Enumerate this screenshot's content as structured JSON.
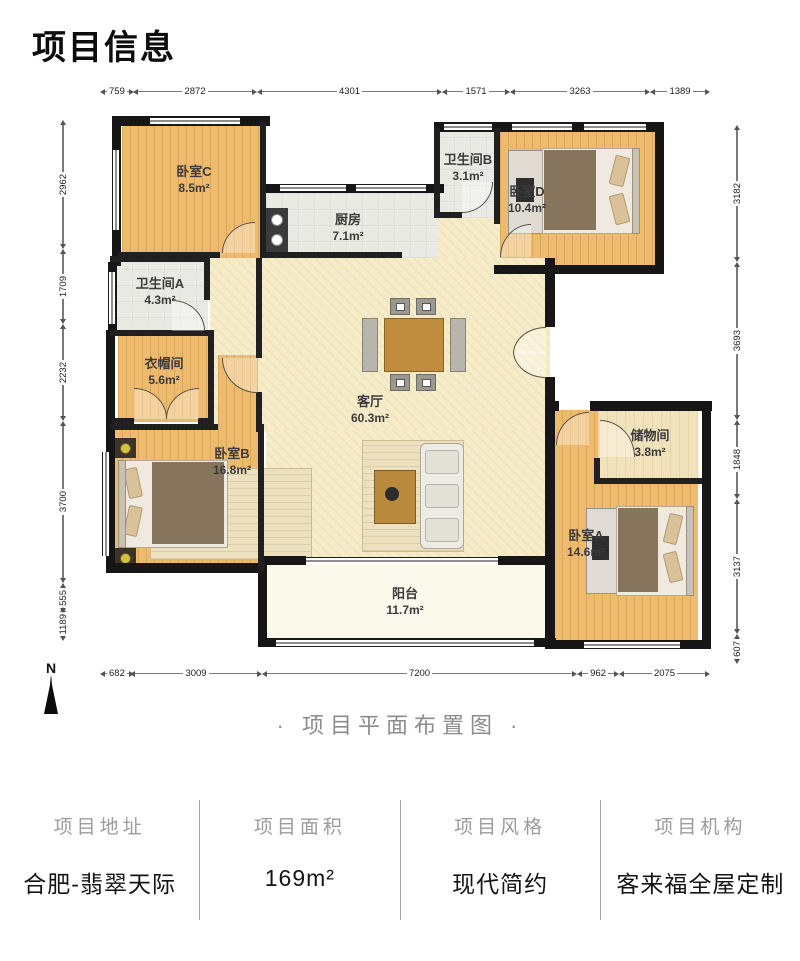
{
  "title": "项目信息",
  "caption": "· 项目平面布置图 ·",
  "compass": {
    "label": "N"
  },
  "plan": {
    "rooms": [
      {
        "name": "卧室C",
        "area": "8.5m²"
      },
      {
        "name": "厨房",
        "area": "7.1m²"
      },
      {
        "name": "卫生间B",
        "area": "3.1m²"
      },
      {
        "name": "卧室D",
        "area": "10.4m²"
      },
      {
        "name": "卫生间A",
        "area": "4.3m²"
      },
      {
        "name": "衣帽间",
        "area": "5.6m²"
      },
      {
        "name": "客厅",
        "area": "60.3m²"
      },
      {
        "name": "卧室B",
        "area": "16.8m²"
      },
      {
        "name": "储物间",
        "area": "3.8m²"
      },
      {
        "name": "卧室A",
        "area": "14.6m²"
      },
      {
        "name": "阳台",
        "area": "11.7m²"
      }
    ],
    "dimensions": {
      "top": [
        "759",
        "2872",
        "4301",
        "1571",
        "3263",
        "1389"
      ],
      "left": [
        "2962",
        "1709",
        "2232",
        "3700",
        "555",
        "1189"
      ],
      "right": [
        "3182",
        "3693",
        "1848",
        "3137",
        "607"
      ],
      "bottom": [
        "682",
        "3009",
        "7200",
        "962",
        "2075"
      ]
    }
  },
  "info": {
    "columns": [
      {
        "label": "项目地址",
        "value": "合肥-翡翠天际"
      },
      {
        "label": "项目面积",
        "value": "169m²"
      },
      {
        "label": "项目风格",
        "value": "现代简约"
      },
      {
        "label": "项目机构",
        "value": "客来福全屋定制"
      }
    ]
  },
  "colors": {
    "wall": "#161616",
    "wood_floor": "#eebb6e",
    "living_floor": "#f6ecc9",
    "tile_floor": "#eaeae4",
    "balcony_floor": "#fbf8ec",
    "label_text": "#3b3b3b",
    "muted_text": "#9c9c9c"
  }
}
